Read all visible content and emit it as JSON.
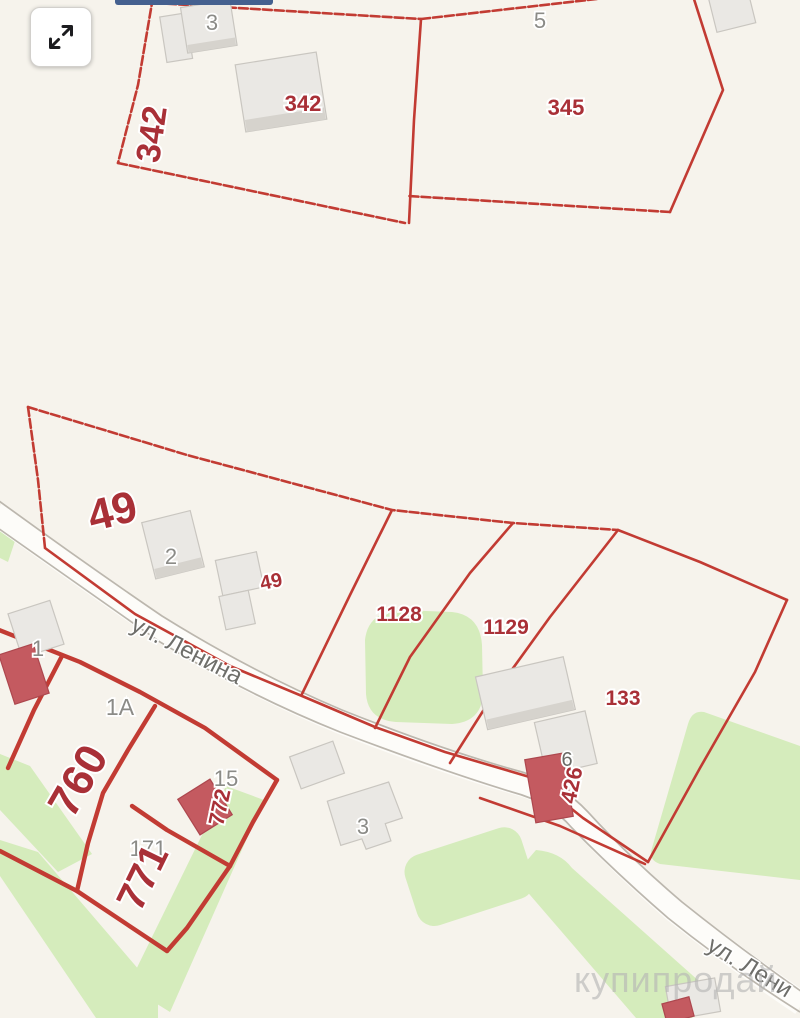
{
  "theme": {
    "bg": "#f6f3ec",
    "line_red": "#c23b33",
    "label_red": "#a93037",
    "label_gray": "#8b8b87",
    "street_gray": "#6e6e6a",
    "green": "#d5ecbc",
    "road_edge": "#bcb7ae",
    "building_fill": "#eae8e4",
    "building_side": "#d6d3cd",
    "red_building": "#c45a60",
    "watermark_color": "#b5b5b5",
    "topbar_blue": "#44608f"
  },
  "controls": {
    "expand_icon": "expand-arrows-icon"
  },
  "labels": {
    "p342_rotated": "342",
    "p342": "342",
    "p345": "345",
    "b5": "5",
    "b3_top": "3",
    "p49_big": "49",
    "b2": "2",
    "p49_small": "49",
    "p1128": "1128",
    "p1129": "1129",
    "p133": "133",
    "b1": "1",
    "p1a": "1A",
    "p760": "760",
    "b15": "15",
    "p772": "772",
    "b171": "171",
    "p771": "771",
    "b3_mid": "3",
    "b6": "6",
    "p426": "426"
  },
  "streets": {
    "lenina_mid": "ул. Ленина",
    "lenina_bottom": "ул. Лени"
  },
  "watermark": {
    "text": "купипродай"
  }
}
